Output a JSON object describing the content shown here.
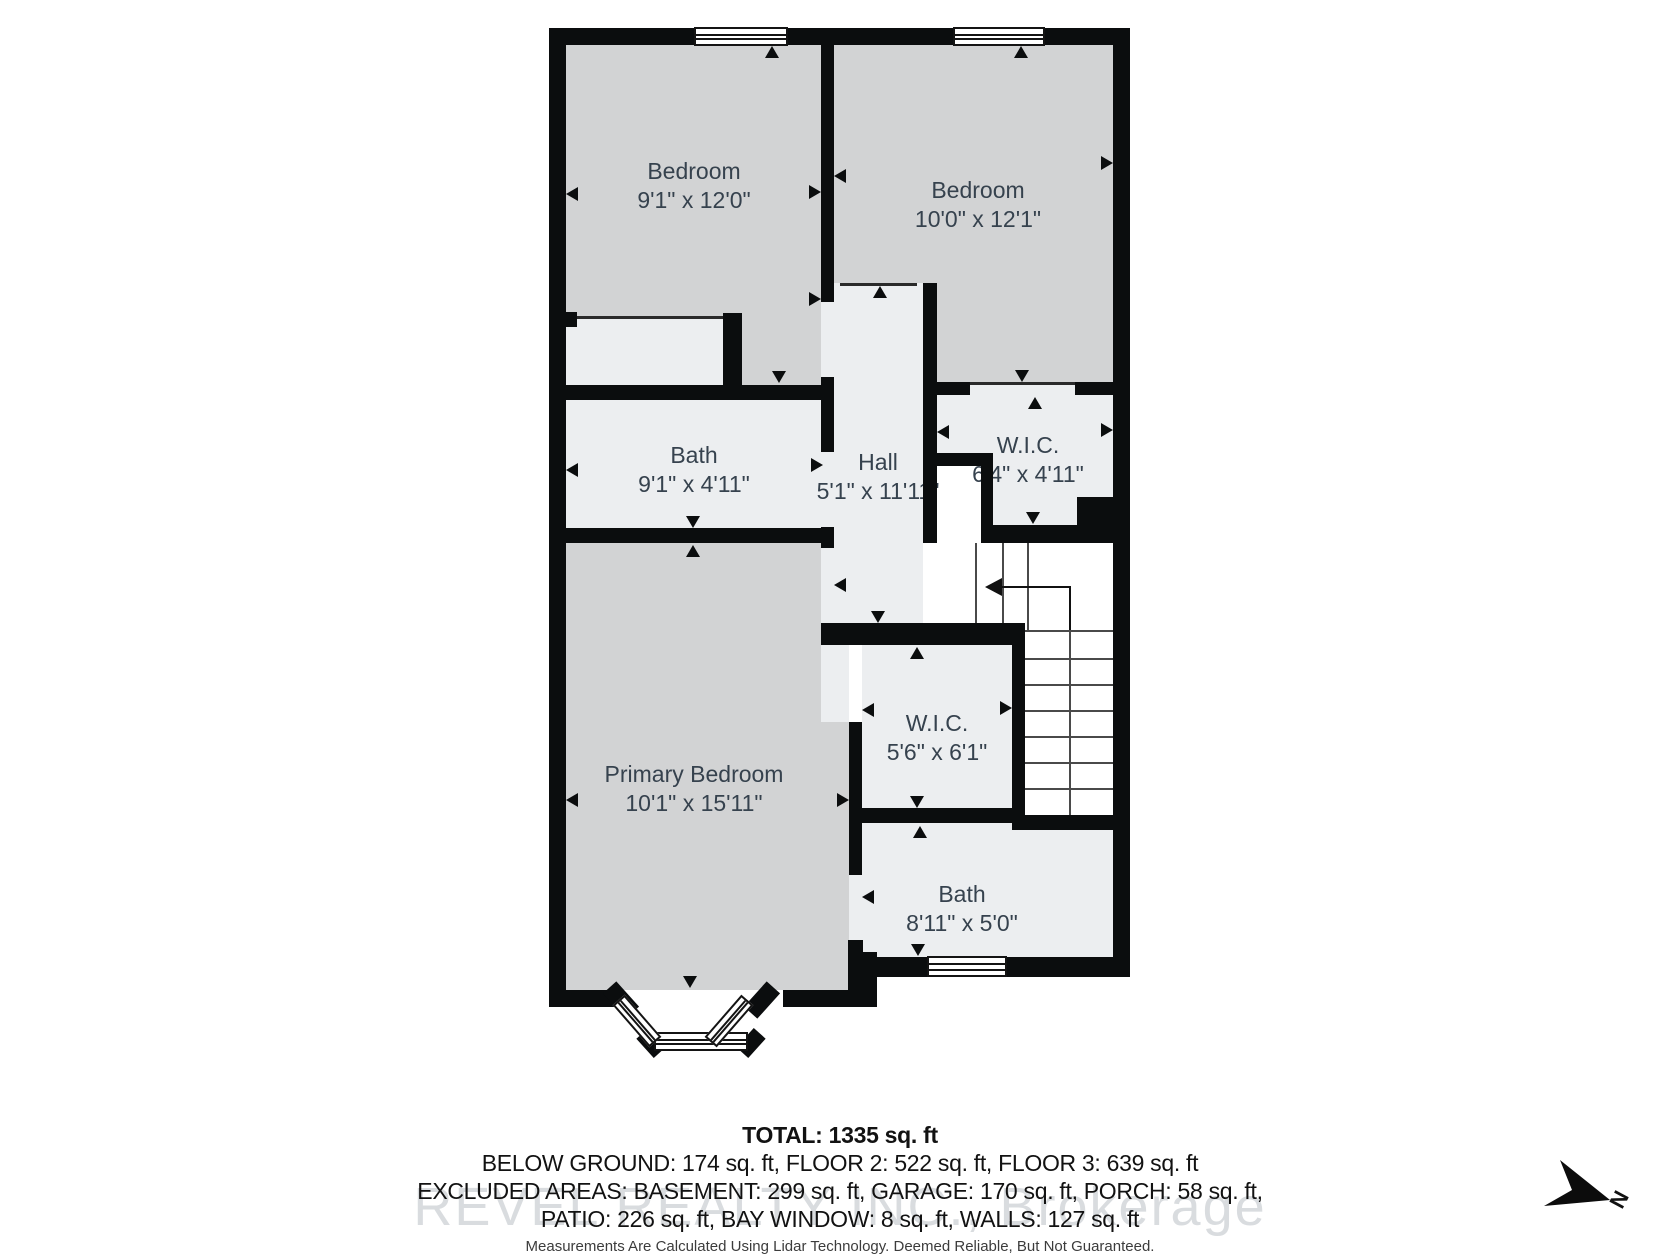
{
  "floorplan": {
    "rooms": [
      {
        "name": "Bedroom",
        "dims": "9'1\" x 12'0\""
      },
      {
        "name": "Bedroom",
        "dims": "10'0\" x 12'1\""
      },
      {
        "name": "Bath",
        "dims": "9'1\" x 4'11\""
      },
      {
        "name": "Hall",
        "dims": "5'1\" x 11'11\""
      },
      {
        "name": "W.I.C.",
        "dims": "6'4\" x 4'11\""
      },
      {
        "name": "Primary Bedroom",
        "dims": "10'1\" x 15'11\""
      },
      {
        "name": "W.I.C.",
        "dims": "5'6\" x 6'1\""
      },
      {
        "name": "Bath",
        "dims": "8'11\" x 5'0\""
      }
    ]
  },
  "summary": {
    "total": "TOTAL: 1335 sq. ft",
    "line2": "BELOW GROUND: 174 sq. ft, FLOOR 2: 522 sq. ft, FLOOR 3: 639 sq. ft",
    "line3": "EXCLUDED AREAS: BASEMENT: 299 sq. ft, GARAGE: 170 sq. ft, PORCH: 58 sq. ft,",
    "line4": "PATIO: 226 sq. ft, BAY WINDOW: 8 sq. ft, WALLS: 127 sq. ft",
    "disclaimer": "Measurements Are Calculated Using Lidar Technology. Deemed Reliable, But Not Guaranteed."
  },
  "watermark": "REVEL REALTY INC., Brokerage",
  "compass": {
    "label": "N"
  },
  "colors": {
    "wall": "#0b0d0e",
    "room_gray": "#d2d3d4",
    "room_light": "#eceef0",
    "stairs": "#ffffff",
    "label_text": "#36424e"
  }
}
